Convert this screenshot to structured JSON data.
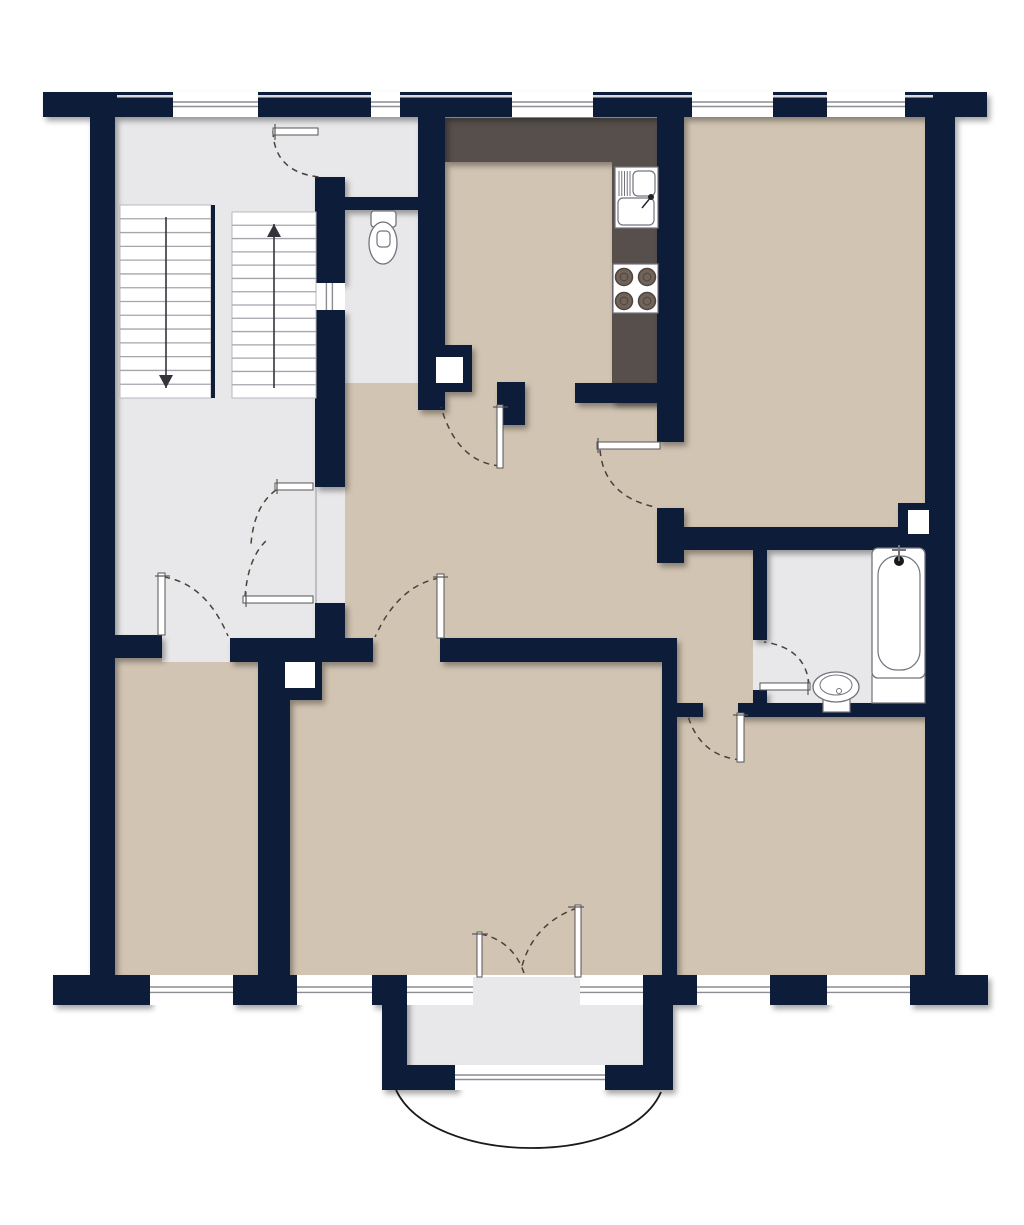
{
  "canvas": {
    "width": 1024,
    "height": 1225,
    "background": "#ffffff"
  },
  "palette": {
    "wall": "#0F1D38",
    "room_beige": "#D2C4B2",
    "floor_gray": "#E8E8EA",
    "counter_dark": "#57504C",
    "white": "#FFFFFF",
    "window_line": "#8C8C92",
    "door_dash": "#4A4236",
    "fixture_stroke": "#73737D",
    "stair_tread": "#A5A5AC",
    "arrow": "#33333A",
    "burner_fill": "#6F635A",
    "burner_ring": "#50453C",
    "facade_line": "#D9DBE0",
    "boundary_line": "#B0B0B6",
    "curve_line": "#1A1A1A"
  },
  "floors": [
    {
      "name": "stairwell-landing-floor",
      "x": 115,
      "y": 117,
      "w": 200,
      "h": 528,
      "color": "floor_gray"
    },
    {
      "name": "stairwell-door-opening-floor",
      "x": 315,
      "y": 117,
      "w": 30,
      "h": 60,
      "color": "floor_gray"
    },
    {
      "name": "entrance-opening-floor",
      "x": 315,
      "y": 487,
      "w": 30,
      "h": 116,
      "color": "floor_gray"
    },
    {
      "name": "wc-corridor-floor",
      "x": 345,
      "y": 117,
      "w": 73,
      "h": 293,
      "color": "floor_gray"
    },
    {
      "name": "kitchen-floor",
      "x": 445,
      "y": 117,
      "w": 212,
      "h": 286,
      "color": "room_beige"
    },
    {
      "name": "top-right-room-floor",
      "x": 684,
      "y": 117,
      "w": 241,
      "h": 410,
      "color": "room_beige"
    },
    {
      "name": "hallway-floor",
      "x": 345,
      "y": 383,
      "w": 339,
      "h": 262,
      "color": "room_beige"
    },
    {
      "name": "top-right-room-door-opening-floor",
      "x": 657,
      "y": 442,
      "w": 27,
      "h": 121,
      "color": "room_beige"
    },
    {
      "name": "bath-corridor-floor",
      "x": 677,
      "y": 550,
      "w": 76,
      "h": 155,
      "color": "room_beige"
    },
    {
      "name": "bathroom-floor",
      "x": 767,
      "y": 550,
      "w": 158,
      "h": 155,
      "color": "floor_gray"
    },
    {
      "name": "bathroom-door-opening-floor",
      "x": 753,
      "y": 640,
      "w": 14,
      "h": 50,
      "color": "floor_gray"
    },
    {
      "name": "bottom-right-door-opening-floor",
      "x": 703,
      "y": 703,
      "w": 35,
      "h": 14,
      "color": "room_beige"
    },
    {
      "name": "bottom-left-room-floor",
      "x": 115,
      "y": 658,
      "w": 143,
      "h": 317,
      "color": "room_beige"
    },
    {
      "name": "bottom-left-door-opening-floor",
      "x": 162,
      "y": 635,
      "w": 68,
      "h": 27,
      "color": "floor_gray"
    },
    {
      "name": "living-room-floor",
      "x": 290,
      "y": 662,
      "w": 372,
      "h": 313,
      "color": "room_beige"
    },
    {
      "name": "living-room-door-opening-floor",
      "x": 373,
      "y": 638,
      "w": 67,
      "h": 26,
      "color": "room_beige"
    },
    {
      "name": "bottom-right-room-floor",
      "x": 677,
      "y": 715,
      "w": 248,
      "h": 260,
      "color": "room_beige"
    },
    {
      "name": "balcony-floor",
      "x": 407,
      "y": 1005,
      "w": 236,
      "h": 62,
      "color": "floor_gray"
    },
    {
      "name": "balcony-threshold-floor",
      "x": 473,
      "y": 977,
      "w": 107,
      "h": 28,
      "color": "floor_gray"
    }
  ],
  "counters": [
    {
      "name": "kitchen-counter-top",
      "x": 445,
      "y": 118,
      "w": 215,
      "h": 44
    },
    {
      "name": "kitchen-counter-right",
      "x": 612,
      "y": 162,
      "w": 48,
      "h": 241
    }
  ],
  "walls": [
    {
      "name": "exterior-wall-top",
      "x": 43,
      "y": 92,
      "w": 944,
      "h": 25
    },
    {
      "name": "exterior-wall-left",
      "x": 90,
      "y": 117,
      "w": 25,
      "h": 888
    },
    {
      "name": "exterior-wall-right",
      "x": 925,
      "y": 117,
      "w": 30,
      "h": 858
    },
    {
      "name": "exterior-wall-bottom-1",
      "x": 53,
      "y": 975,
      "w": 97,
      "h": 30
    },
    {
      "name": "exterior-wall-bottom-2",
      "x": 233,
      "y": 975,
      "w": 64,
      "h": 30
    },
    {
      "name": "exterior-wall-bottom-3",
      "x": 372,
      "y": 975,
      "w": 35,
      "h": 30
    },
    {
      "name": "balcony-wall-right",
      "x": 643,
      "y": 975,
      "w": 30,
      "h": 115
    },
    {
      "name": "exterior-wall-bottom-4",
      "x": 673,
      "y": 975,
      "w": 24,
      "h": 30
    },
    {
      "name": "exterior-wall-bottom-5",
      "x": 770,
      "y": 975,
      "w": 57,
      "h": 30
    },
    {
      "name": "exterior-wall-bottom-6",
      "x": 910,
      "y": 975,
      "w": 78,
      "h": 30
    },
    {
      "name": "balcony-wall-left",
      "x": 382,
      "y": 1005,
      "w": 25,
      "h": 85
    },
    {
      "name": "balcony-wall-bottom-l",
      "x": 382,
      "y": 1065,
      "w": 75,
      "h": 25
    },
    {
      "name": "balcony-wall-bottom-r",
      "x": 603,
      "y": 1065,
      "w": 65,
      "h": 25
    },
    {
      "name": "stairwell-wall-seg1",
      "x": 315,
      "y": 177,
      "w": 30,
      "h": 106
    },
    {
      "name": "stairwell-wall-seg2",
      "x": 315,
      "y": 310,
      "w": 30,
      "h": 177
    },
    {
      "name": "stairwell-wall-seg3",
      "x": 315,
      "y": 603,
      "w": 30,
      "h": 42
    },
    {
      "name": "wc-kitchen-wall",
      "x": 418,
      "y": 117,
      "w": 27,
      "h": 293
    },
    {
      "name": "wc-divider-wall",
      "x": 340,
      "y": 197,
      "w": 83,
      "h": 13
    },
    {
      "name": "kitchen-bottom-wall",
      "x": 575,
      "y": 383,
      "w": 85,
      "h": 20
    },
    {
      "name": "kitchen-door-stub",
      "x": 497,
      "y": 382,
      "w": 28,
      "h": 43
    },
    {
      "name": "kitchen-topright-wall",
      "x": 657,
      "y": 117,
      "w": 27,
      "h": 325
    },
    {
      "name": "hall-junction-stub",
      "x": 657,
      "y": 508,
      "w": 27,
      "h": 55
    },
    {
      "name": "topright-room-bottom-wall",
      "x": 673,
      "y": 527,
      "w": 227,
      "h": 23
    },
    {
      "name": "bathroom-left-wall-upper",
      "x": 753,
      "y": 550,
      "w": 14,
      "h": 90
    },
    {
      "name": "bathroom-left-wall-lower",
      "x": 753,
      "y": 690,
      "w": 14,
      "h": 27
    },
    {
      "name": "bathroom-bottom-stub",
      "x": 677,
      "y": 703,
      "w": 26,
      "h": 14
    },
    {
      "name": "bathroom-bottom-wall",
      "x": 738,
      "y": 703,
      "w": 187,
      "h": 14
    },
    {
      "name": "hall-bottomrooms-wall-1",
      "x": 102,
      "y": 635,
      "w": 60,
      "h": 23
    },
    {
      "name": "hall-bottomrooms-wall-2",
      "x": 230,
      "y": 638,
      "w": 143,
      "h": 24
    },
    {
      "name": "hall-bottomrooms-wall-3",
      "x": 440,
      "y": 638,
      "w": 237,
      "h": 24
    },
    {
      "name": "bottomleft-living-divider",
      "x": 258,
      "y": 662,
      "w": 32,
      "h": 313
    },
    {
      "name": "living-bottomright-divider",
      "x": 662,
      "y": 640,
      "w": 15,
      "h": 335
    },
    {
      "name": "niche-block-kitchen",
      "x": 420,
      "y": 345,
      "w": 52,
      "h": 47
    },
    {
      "name": "niche-block-living",
      "x": 272,
      "y": 645,
      "w": 50,
      "h": 55
    },
    {
      "name": "niche-block-bathroom",
      "x": 898,
      "y": 503,
      "w": 35,
      "h": 47
    }
  ],
  "niche_insets": [
    {
      "name": "niche-kitchen",
      "x": 436,
      "y": 357,
      "w": 27,
      "h": 26
    },
    {
      "name": "niche-living",
      "x": 285,
      "y": 662,
      "w": 30,
      "h": 26
    },
    {
      "name": "niche-bathroom",
      "x": 908,
      "y": 510,
      "w": 21,
      "h": 24
    }
  ],
  "facade_lines": [
    {
      "x": 117,
      "w": 56
    },
    {
      "x": 258,
      "w": 113
    },
    {
      "x": 400,
      "w": 112
    },
    {
      "x": 593,
      "w": 99
    },
    {
      "x": 773,
      "w": 54
    },
    {
      "x": 905,
      "w": 28
    }
  ],
  "windows": [
    {
      "name": "window-stairwell-top",
      "x": 173,
      "y": 92,
      "w": 85,
      "h": 25,
      "orient": "h"
    },
    {
      "name": "window-wc-top",
      "x": 371,
      "y": 92,
      "w": 29,
      "h": 25,
      "orient": "h"
    },
    {
      "name": "window-kitchen-top",
      "x": 512,
      "y": 92,
      "w": 81,
      "h": 25,
      "orient": "h"
    },
    {
      "name": "window-topright-1",
      "x": 692,
      "y": 92,
      "w": 81,
      "h": 25,
      "orient": "h"
    },
    {
      "name": "window-topright-2",
      "x": 827,
      "y": 92,
      "w": 78,
      "h": 25,
      "orient": "h"
    },
    {
      "name": "window-bottomleft",
      "x": 150,
      "y": 975,
      "w": 83,
      "h": 30,
      "orient": "h"
    },
    {
      "name": "window-living-1",
      "x": 297,
      "y": 975,
      "w": 75,
      "h": 30,
      "orient": "h"
    },
    {
      "name": "window-living-2",
      "x": 407,
      "y": 975,
      "w": 66,
      "h": 30,
      "orient": "h"
    },
    {
      "name": "window-living-3",
      "x": 580,
      "y": 975,
      "w": 63,
      "h": 30,
      "orient": "h"
    },
    {
      "name": "window-bottomright-1",
      "x": 697,
      "y": 975,
      "w": 73,
      "h": 30,
      "orient": "h"
    },
    {
      "name": "window-bottomright-2",
      "x": 827,
      "y": 975,
      "w": 83,
      "h": 30,
      "orient": "h"
    },
    {
      "name": "window-balcony",
      "x": 455,
      "y": 1065,
      "w": 150,
      "h": 25,
      "orient": "h"
    },
    {
      "name": "window-stairwell-interior",
      "x": 315,
      "y": 283,
      "w": 30,
      "h": 27,
      "orient": "v"
    }
  ],
  "boundary_lines": [
    {
      "name": "entrance-threshold-line",
      "x1": 316,
      "y1": 487,
      "x2": 316,
      "y2": 603
    }
  ],
  "stairs": {
    "flights": [
      {
        "name": "stair-flight-down",
        "x": 120,
        "y": 205,
        "w": 91,
        "h": 193,
        "treads": 13,
        "arrow": "down",
        "ax": 166
      },
      {
        "name": "stair-flight-up",
        "x": 232,
        "y": 212,
        "w": 84,
        "h": 186,
        "treads": 13,
        "arrow": "up",
        "ax": 274
      }
    ],
    "divider": {
      "x": 211,
      "y": 205,
      "w": 4,
      "h": 193
    }
  },
  "fixtures": {
    "toilet": {
      "tank": {
        "x": 371,
        "y": 211,
        "w": 25,
        "h": 16
      },
      "bowl": {
        "cx": 383,
        "cy": 243,
        "rx": 14,
        "ry": 21
      },
      "seat": {
        "x": 377,
        "y": 231,
        "w": 13,
        "h": 16
      }
    },
    "kitchen_sink": {
      "body": {
        "x": 615,
        "y": 167,
        "w": 43,
        "h": 61
      },
      "bowl_small": {
        "x": 633,
        "y": 171,
        "w": 22,
        "h": 25
      },
      "bowl_large": {
        "x": 618,
        "y": 198,
        "w": 36,
        "h": 27
      },
      "drain_lines": {
        "x1": 619,
        "x2": 630,
        "y1": 171,
        "y2": 196,
        "count": 5
      },
      "faucet": {
        "cx": 651,
        "cy": 197,
        "r": 3
      }
    },
    "stove": {
      "body": {
        "x": 613,
        "y": 264,
        "w": 45,
        "h": 49
      },
      "burner_r": 8.5,
      "burners": [
        [
          624,
          277
        ],
        [
          647,
          277
        ],
        [
          624,
          301
        ],
        [
          647,
          301
        ]
      ]
    },
    "bathtub": {
      "apron": {
        "x": 872,
        "y": 675,
        "w": 53,
        "h": 28
      },
      "outer": {
        "x": 872,
        "y": 548,
        "w": 53,
        "h": 130
      },
      "inner": {
        "x": 878,
        "y": 556,
        "w": 42,
        "h": 114
      },
      "faucet": {
        "cx": 899,
        "cy": 561,
        "r": 5
      }
    },
    "basin": {
      "outer": {
        "cx": 836,
        "cy": 687,
        "rx": 23,
        "ry": 15
      },
      "inner": {
        "cx": 836,
        "cy": 685,
        "rx": 16,
        "ry": 10
      },
      "pedestal": {
        "x": 823,
        "y": 699,
        "w": 27,
        "h": 13
      },
      "drain": {
        "cx": 839,
        "cy": 691,
        "r": 2.5
      }
    }
  },
  "doors": [
    {
      "name": "stairwell-door",
      "leaf": [
        273,
        128,
        45,
        7
      ],
      "arc": "M273,131 Q274,172 319,177",
      "tick": [
        275,
        124,
        275,
        140
      ]
    },
    {
      "name": "entrance-door-leaf-a",
      "leaf": [
        275,
        483,
        38,
        7
      ],
      "arc": "M276,490 Q254,506 251,544",
      "tick": [
        277,
        479,
        277,
        494
      ]
    },
    {
      "name": "entrance-door-leaf-b",
      "leaf": [
        243,
        596,
        70,
        7
      ],
      "arc": "M245,597 Q248,557 267,540",
      "tick": [
        246,
        592,
        246,
        607
      ]
    },
    {
      "name": "kitchen-door",
      "leaf": [
        497,
        405,
        6,
        63
      ],
      "arc": "M500,466 Q457,462 441,407",
      "tick": [
        493,
        407,
        508,
        407
      ]
    },
    {
      "name": "top-right-room-door",
      "leaf": [
        597,
        442,
        63,
        7
      ],
      "arc": "M600,450 Q604,496 655,507",
      "tick": [
        598,
        438,
        598,
        453
      ]
    },
    {
      "name": "bathroom-door",
      "leaf": [
        760,
        683,
        50,
        7
      ],
      "arc": "M809,685 Q806,648 764,642",
      "tick": [
        808,
        679,
        808,
        695
      ]
    },
    {
      "name": "bottom-right-room-door",
      "leaf": [
        737,
        713,
        7,
        49
      ],
      "arc": "M741,760 Q700,756 688,716",
      "tick": [
        733,
        715,
        748,
        715
      ]
    },
    {
      "name": "living-room-door",
      "leaf": [
        437,
        574,
        7,
        64
      ],
      "arc": "M439,578 Q398,586 375,637",
      "tick": [
        433,
        577,
        448,
        577
      ]
    },
    {
      "name": "bottom-left-room-door",
      "leaf": [
        158,
        573,
        7,
        62
      ],
      "arc": "M164,577 Q206,584 228,636",
      "tick": [
        155,
        576,
        170,
        576
      ]
    },
    {
      "name": "balcony-door-left",
      "leaf": [
        477,
        932,
        5,
        45
      ],
      "arc": "M481,934 Q513,941 524,973",
      "tick": [
        472,
        934,
        488,
        934
      ]
    },
    {
      "name": "balcony-door-right",
      "leaf": [
        575,
        905,
        6,
        72
      ],
      "arc": "M577,908 Q532,924 521,970",
      "tick": [
        568,
        907,
        584,
        907
      ]
    }
  ],
  "balcony": {
    "curve": "M396,1090 C432,1166 628,1168 661,1092"
  }
}
